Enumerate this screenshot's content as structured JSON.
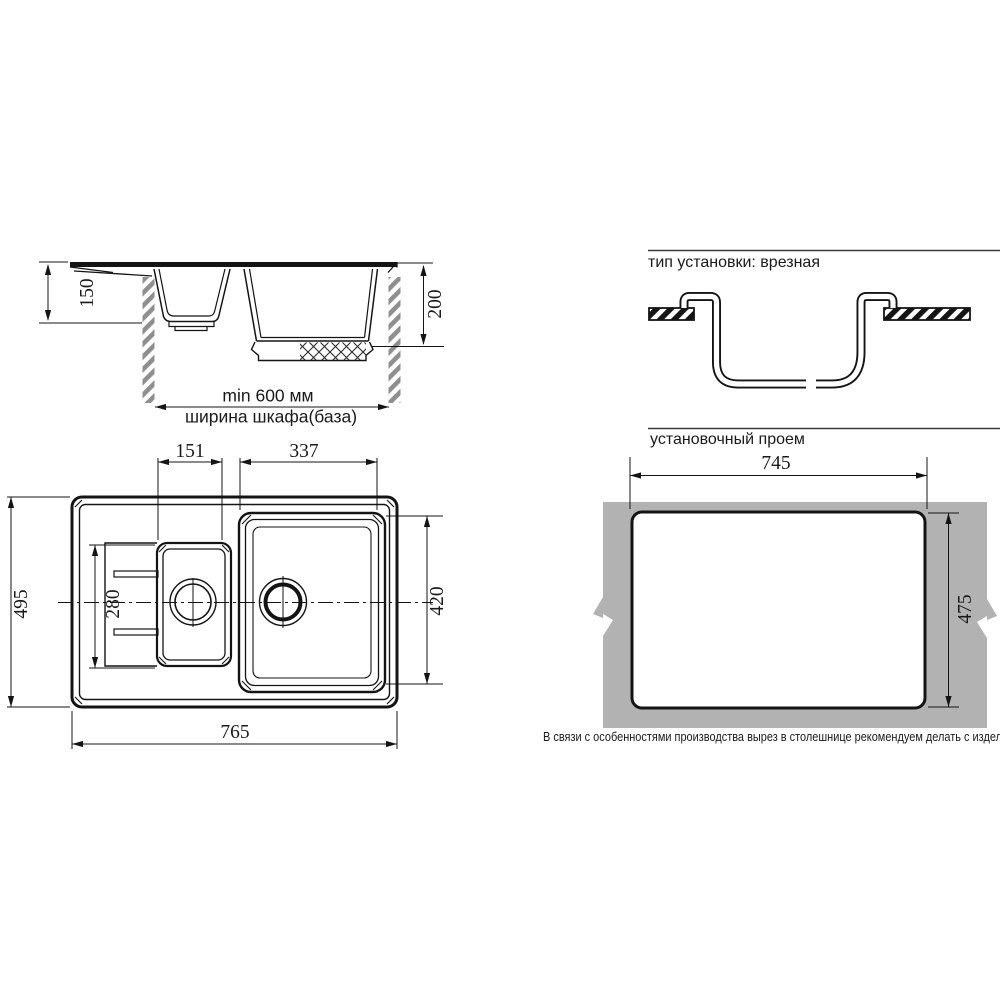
{
  "side_view": {
    "dims": {
      "small_bowl_depth": "150",
      "main_bowl_depth": "200",
      "cabinet_min_width": "min 600 мм",
      "cabinet_caption": "ширина шкафа(база)"
    }
  },
  "installation": {
    "title": "тип установки: врезная"
  },
  "top_view": {
    "dims": {
      "small_bowl_width": "151",
      "main_bowl_width": "337",
      "overall_depth": "495",
      "small_bowl_length": "280",
      "main_bowl_length": "420",
      "overall_width": "765"
    }
  },
  "cutout": {
    "title": "установочный проем",
    "dims": {
      "width": "745",
      "height": "475"
    },
    "note": "В связи с особенностями производства вырез в столешнице рекомендуем делать с изделия."
  },
  "colors": {
    "countertop_gray": "#b2b2b2",
    "line_color": "#141414"
  }
}
